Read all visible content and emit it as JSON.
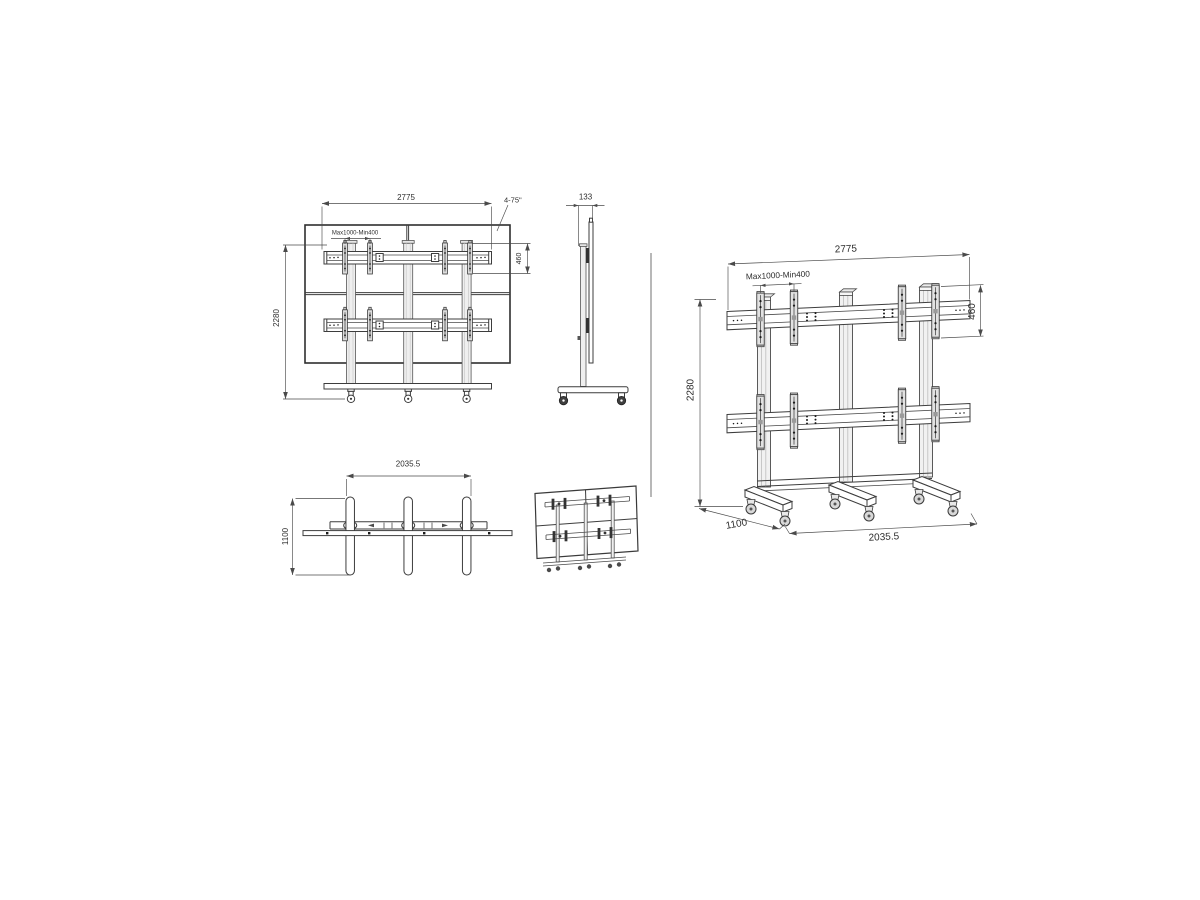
{
  "colors": {
    "line": "#3d3d3d",
    "dimension_line": "#4a4a4a",
    "text": "#2e2e2e",
    "pole_fill": "#efefef",
    "bracket_fill": "#dcdcdc",
    "background": "#ffffff"
  },
  "views": {
    "front": {
      "dim_width": "2775",
      "dim_screen_range": "4-75\"",
      "dim_vesa": "Max1000-Min400",
      "dim_bracket_height": "460",
      "dim_total_height": "2280"
    },
    "side": {
      "dim_depth": "133"
    },
    "top": {
      "dim_base_width": "2035.5",
      "dim_base_depth": "1100"
    },
    "perspective": {
      "dim_width": "2775",
      "dim_vesa": "Max1000-Min400",
      "dim_bracket_height": "460",
      "dim_total_height": "2280",
      "dim_base_depth": "1100",
      "dim_base_width": "2035.5"
    }
  }
}
